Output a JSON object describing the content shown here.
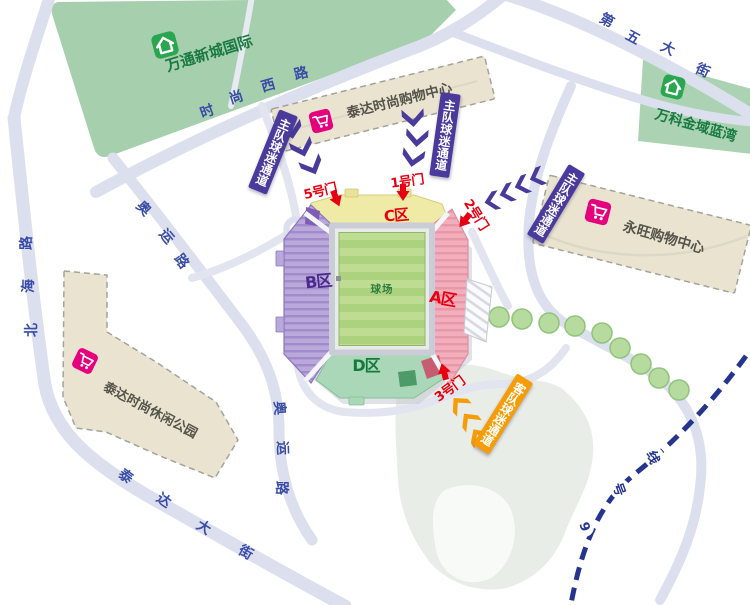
{
  "places": {
    "wantong_xincheng": "万通新城国际",
    "vanke_jinyu": "万科金域蓝湾",
    "teda_mall": "泰达时尚购物中心",
    "aeon_mall": "永旺购物中心",
    "teda_park": "泰达时尚休闲公园"
  },
  "roads": {
    "shishang_west_rd": {
      "name": "时尚西路",
      "chars": [
        "时",
        "尚",
        "西",
        "路"
      ]
    },
    "fifth_avenue": {
      "name": "第五大街",
      "chars": [
        "第",
        "五",
        "大",
        "街"
      ]
    },
    "beihai_rd": {
      "name": "北海路",
      "chars": [
        "北",
        "海",
        "路"
      ]
    },
    "aoyun_rd_nw": {
      "name": "奥运路",
      "chars": [
        "奥",
        "运",
        "路"
      ]
    },
    "aoyun_rd_s": {
      "name": "奥运路",
      "chars": [
        "奥",
        "运",
        "路"
      ]
    },
    "teda_avenue": {
      "name": "泰达大街",
      "chars": [
        "泰",
        "达",
        "大",
        "街"
      ]
    }
  },
  "metro_line9": {
    "name": "9号线",
    "chars": [
      "9",
      "号",
      "线"
    ]
  },
  "stadium": {
    "zone_a": "A区",
    "zone_b": "B区",
    "zone_c": "C区",
    "zone_d": "D区",
    "pitch": "球场"
  },
  "gates": {
    "gate1": "1号门",
    "gate2": "2号门",
    "gate3": "3号门",
    "gate5": "5号门"
  },
  "channels": {
    "home_fans": "主队球迷通道",
    "away_fans": "客队球迷通道"
  },
  "icons": {
    "residential": "home-icon",
    "shopping": "shopping-cart-icon"
  },
  "colors": {
    "road_label": "#3a4da6",
    "metro_line": "#24348f",
    "gate_text": "#e60012",
    "home_channel": "#4a3a9c",
    "away_channel": "#f59c07",
    "residential_block": "#a5cfad",
    "building_block": "#eae3d0",
    "zone_a_pink": "#f3aebc",
    "zone_b_purple": "#b9a8da",
    "zone_c_yellow": "#efeaa6",
    "zone_d_green": "#aad7b7",
    "pitch_green": "#bedc92",
    "lake": "#e8ede8",
    "road": "#dcdfee"
  }
}
